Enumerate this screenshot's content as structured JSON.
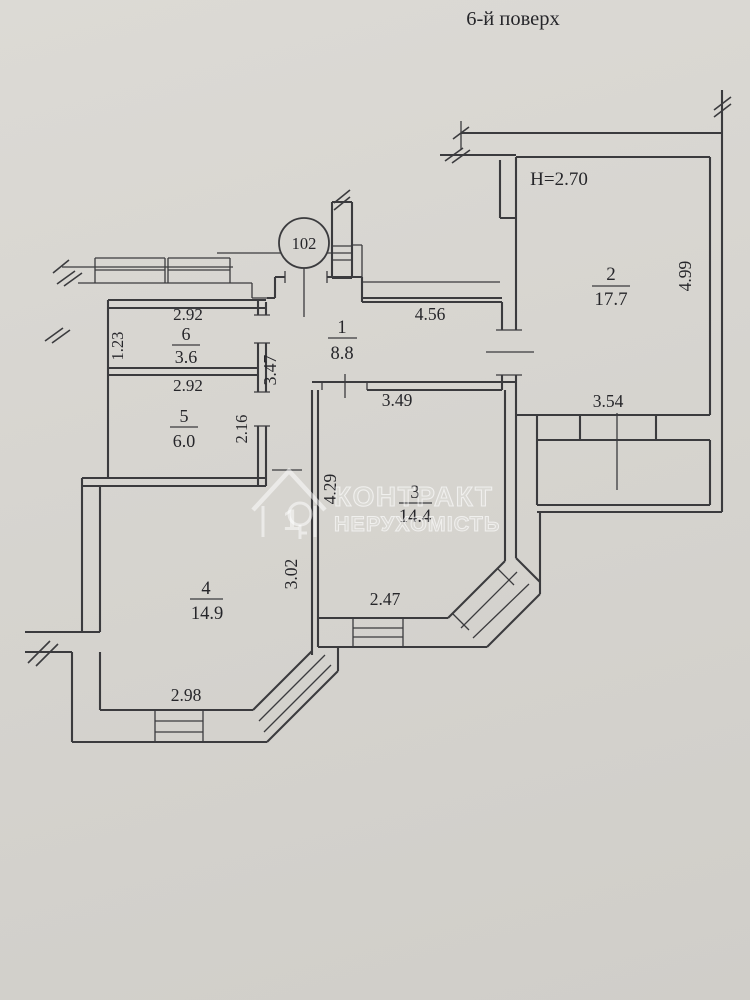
{
  "title": {
    "floor": "6-й поверх"
  },
  "apartment": {
    "number": "102",
    "height_note": "H=2.70"
  },
  "rooms": {
    "r1": {
      "num": "1",
      "area": "8.8"
    },
    "r2": {
      "num": "2",
      "area": "17.7"
    },
    "r3": {
      "num": "3",
      "area": "14.4"
    },
    "r4": {
      "num": "4",
      "area": "14.9"
    },
    "r5": {
      "num": "5",
      "area": "6.0"
    },
    "r6": {
      "num": "6",
      "area": "3.6"
    }
  },
  "dims": {
    "r1_top": "4.56",
    "r1_left": "3.47",
    "r2_right": "4.99",
    "r2_balcony": "3.54",
    "r3_top": "3.49",
    "r3_left": "4.29",
    "r3_bottom": "2.47",
    "r4_right": "3.02",
    "r4_bottom": "2.98",
    "r5_top": "2.92",
    "r5_right": "2.16",
    "r6_top": "2.92",
    "r6_left": "1.23"
  },
  "watermark": {
    "line1": "КОНТРАКТ",
    "line2": "НЕРУХОМІСТЬ",
    "logo_digit": "1"
  },
  "colors": {
    "paper": "#d7d5d0",
    "ink": "#3b3b3e"
  }
}
